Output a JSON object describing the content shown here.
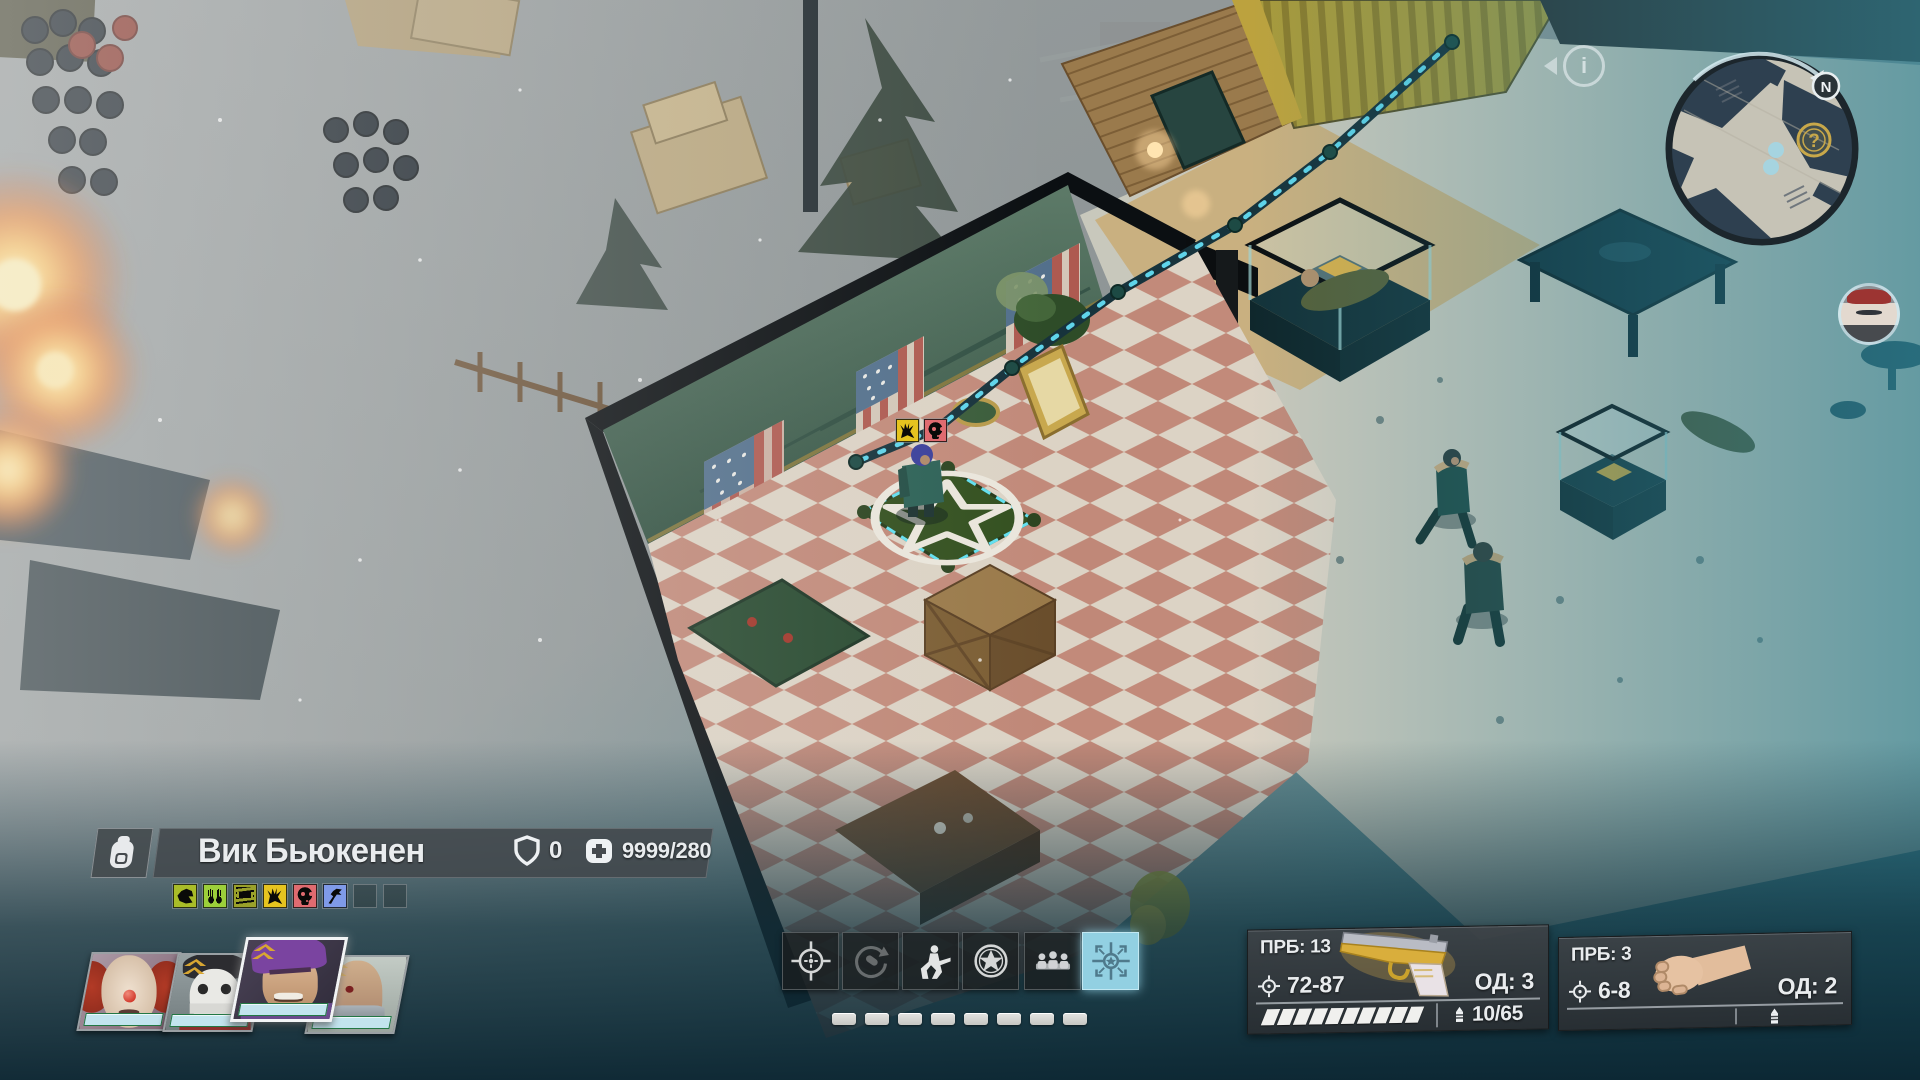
{
  "hud": {
    "info_button": {
      "glyph": "i"
    },
    "minimap": {
      "north_label": "N",
      "question_marker": "?"
    },
    "character_panel": {
      "name": "Вик Бьюкенен",
      "armor_value": "0",
      "health_value": "9999/280",
      "status_effects": [
        {
          "name": "beast-bite",
          "color": "#a9bc28"
        },
        {
          "name": "raised-hands",
          "color": "#9ccf3a"
        },
        {
          "name": "bandaged",
          "color": "#9aa12a"
        },
        {
          "name": "claw",
          "color": "#e6c41f"
        },
        {
          "name": "stunned-face",
          "color": "#e06b70"
        },
        {
          "name": "tomahawk",
          "color": "#7f9ae8"
        }
      ],
      "empty_slots": 2
    },
    "player_buffs": [
      {
        "name": "claw",
        "color": "#e6c41f"
      },
      {
        "name": "stunned-face",
        "color": "#e06b70"
      }
    ],
    "portraits": [
      {
        "name": "clown-companion",
        "selected": false,
        "levelup": false
      },
      {
        "name": "mime-companion",
        "selected": false,
        "levelup": true
      },
      {
        "name": "vic-buchanan",
        "selected": true,
        "levelup": true
      },
      {
        "name": "bald-companion",
        "selected": false,
        "levelup": true
      }
    ],
    "action_bar": {
      "buttons": [
        "attack-reticle",
        "reload",
        "crouch",
        "skills-star",
        "squad-formation",
        "ambush-mode"
      ],
      "selected_index": 5,
      "ap_pips": 8
    },
    "weapon_primary": {
      "penetration": "ПРБ: 13",
      "damage": "72-87",
      "action_points": "ОД: 3",
      "ammo": "10/65",
      "ammo_segments": 10
    },
    "weapon_secondary": {
      "penetration": "ПРБ: 3",
      "damage": "6-8",
      "action_points": "ОД: 2",
      "ammo": ""
    },
    "colors": {
      "selected_button": "#92d0e2",
      "health_bar": "#c2e4ee",
      "marker_gold": "#c8a84a"
    }
  }
}
